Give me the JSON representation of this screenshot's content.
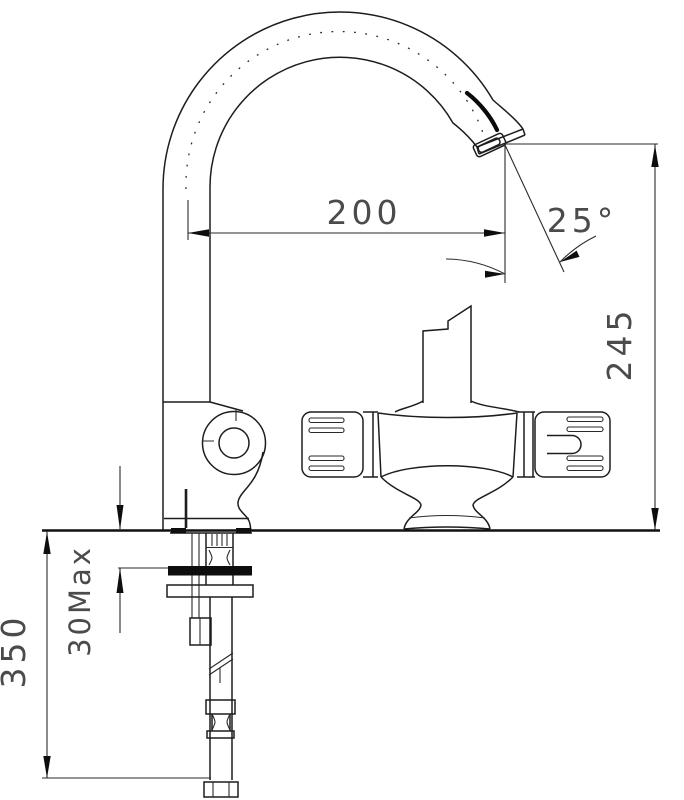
{
  "drawing": {
    "type": "technical-dimension-drawing",
    "subject": "kitchen sink mixer faucet, side elevation with installation dimensions",
    "colors": {
      "background": "#ffffff",
      "line": "#1d1d1d",
      "dimension_text": "#4b4b4b"
    },
    "dimensions": {
      "spout_reach": "200",
      "outlet_angle": "25°",
      "spout_height": "245",
      "supply_length": "350",
      "deck_thickness": "30Max"
    }
  }
}
